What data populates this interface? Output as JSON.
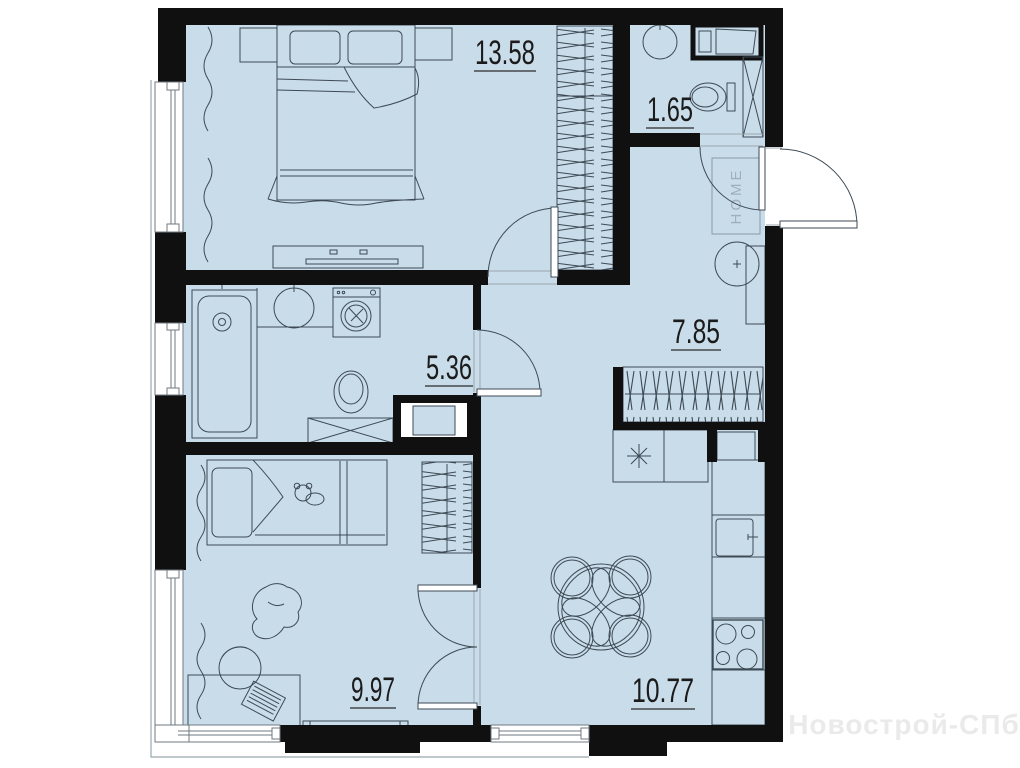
{
  "rooms": {
    "bedroom": {
      "area": "13.58"
    },
    "wc": {
      "area": "1.65"
    },
    "hallway": {
      "area": "7.85"
    },
    "bathroom": {
      "area": "5.36"
    },
    "kids_room": {
      "area": "9.97"
    },
    "kitchen_living": {
      "area": "10.77"
    }
  },
  "doormat_label": "HOME",
  "watermark_text": "Новострой-СПб",
  "colors": {
    "floor_fill": "#c9dcea",
    "wall": "#101010",
    "furniture_line": "#3d4a54"
  }
}
